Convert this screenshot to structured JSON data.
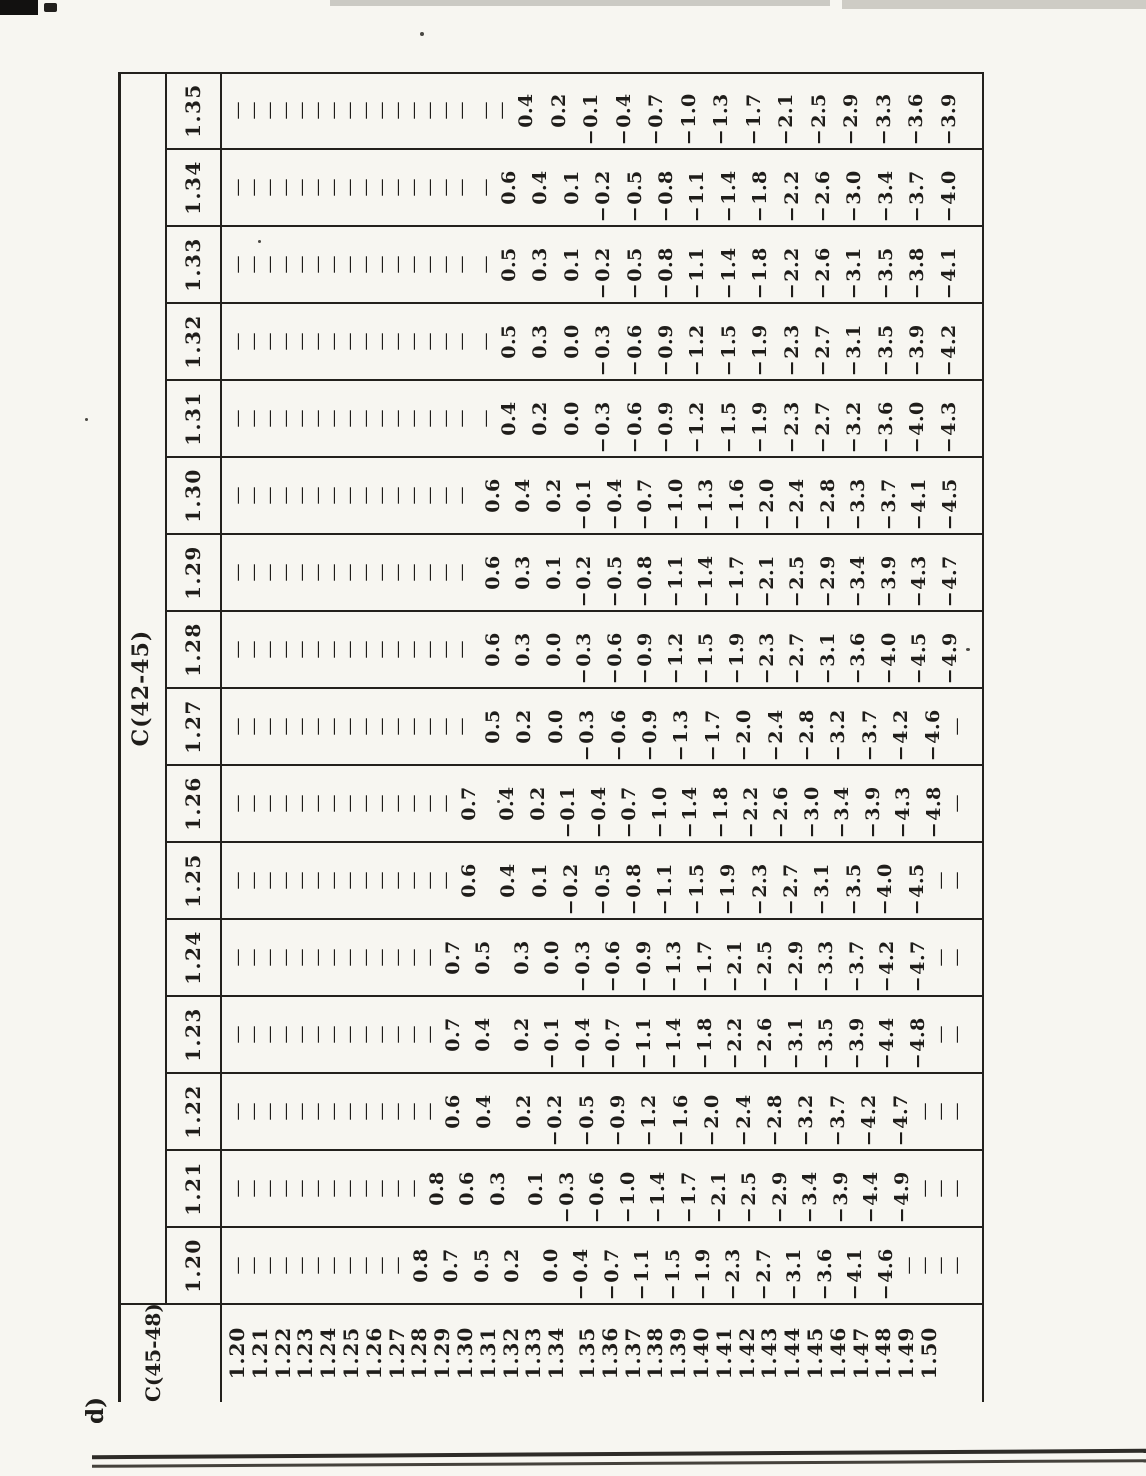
{
  "figure_label": "d)",
  "table": {
    "col_group_label": "C(42-45)",
    "row_group_label": "C(45-48)",
    "dash": "—",
    "columns": [
      "1.20",
      "1.21",
      "1.22",
      "1.23",
      "1.24",
      "1.25",
      "1.26",
      "1.27",
      "1.28",
      "1.29",
      "1.30",
      "1.31",
      "1.32",
      "1.33",
      "1.34",
      "1.35"
    ],
    "row_labels": [
      "1.20",
      "1.21",
      "1.22",
      "1.23",
      "1.24",
      "1.25",
      "1.26",
      "1.27",
      "1.28",
      "1.29",
      "1.30",
      "1.31",
      "1.32",
      "1.33",
      "1.34",
      "1.35",
      "1.36",
      "1.37",
      "1.38",
      "1.39",
      "1.40",
      "1.41",
      "1.42",
      "1.43",
      "1.44",
      "1.45",
      "1.46",
      "1.47",
      "1.48",
      "1.49",
      "1.50"
    ],
    "cells": [
      [
        "—",
        "—",
        "—",
        "—",
        "—",
        "—",
        "—",
        "—",
        "—",
        "—",
        "—",
        "—",
        "—",
        "—",
        "—",
        "—"
      ],
      [
        "—",
        "—",
        "—",
        "—",
        "—",
        "—",
        "—",
        "—",
        "—",
        "—",
        "—",
        "—",
        "—",
        "—",
        "—",
        "—"
      ],
      [
        "—",
        "—",
        "—",
        "—",
        "—",
        "—",
        "—",
        "—",
        "—",
        "—",
        "—",
        "—",
        "—",
        "—",
        "—",
        "—"
      ],
      [
        "—",
        "—",
        "—",
        "—",
        "—",
        "—",
        "—",
        "—",
        "—",
        "—",
        "—",
        "—",
        "—",
        "—",
        "—",
        "—"
      ],
      [
        "—",
        "—",
        "—",
        "—",
        "—",
        "—",
        "—",
        "—",
        "—",
        "—",
        "—",
        "—",
        "—",
        "—",
        "—",
        "—"
      ],
      [
        "—",
        "—",
        "—",
        "—",
        "—",
        "—",
        "—",
        "—",
        "—",
        "—",
        "—",
        "—",
        "—",
        "—",
        "—",
        "—"
      ],
      [
        "—",
        "—",
        "—",
        "—",
        "—",
        "—",
        "—",
        "—",
        "—",
        "—",
        "—",
        "—",
        "—",
        "—",
        "—",
        "—"
      ],
      [
        "—",
        "—",
        "—",
        "—",
        "—",
        "—",
        "—",
        "—",
        "—",
        "—",
        "—",
        "—",
        "—",
        "—",
        "—",
        "—"
      ],
      [
        "—",
        "—",
        "—",
        "—",
        "—",
        "—",
        "—",
        "—",
        "—",
        "—",
        "—",
        "—",
        "—",
        "—",
        "—",
        "—"
      ],
      [
        "—",
        "—",
        "—",
        "—",
        "—",
        "—",
        "—",
        "—",
        "—",
        "—",
        "—",
        "—",
        "—",
        "—",
        "—",
        "—"
      ],
      [
        "—",
        "—",
        "—",
        "—",
        "—",
        "—",
        "—",
        "—",
        "—",
        "—",
        "—",
        "—",
        "—",
        "—",
        "—",
        "—"
      ],
      [
        "0.8",
        "—",
        "—",
        "—",
        "—",
        "—",
        "—",
        "—",
        "—",
        "—",
        "—",
        "—",
        "—",
        "—",
        "—",
        "—"
      ],
      [
        "0.7",
        "0.8",
        "—",
        "—",
        "—",
        "—",
        "—",
        "—",
        "—",
        "—",
        "—",
        "—",
        "—",
        "—",
        "—",
        "—"
      ],
      [
        "0.5",
        "0.6",
        "0.6",
        "0.7",
        "0.7",
        "—",
        "—",
        "—",
        "—",
        "—",
        "—",
        "—",
        "—",
        "—",
        "—",
        "—"
      ],
      [
        "0.2",
        "0.3",
        "0.4",
        "0.4",
        "0.5",
        "0.6",
        "0.7",
        "—",
        "—",
        "—",
        "—",
        "—",
        "—",
        "—",
        "—",
        "—"
      ],
      [
        "0.0",
        "0.1",
        "0.2",
        "0.2",
        "0.3",
        "0.4",
        "0.4",
        "0.5",
        "0.6",
        "0.6",
        "0.6",
        "—",
        "—",
        "—",
        "—",
        "—"
      ],
      [
        "−0.4",
        "−0.3",
        "−0.2",
        "−0.1",
        "0.0",
        "0.1",
        "0.2",
        "0.2",
        "0.3",
        "0.3",
        "0.4",
        "0.4",
        "0.5",
        "0.5",
        "0.6",
        "—"
      ],
      [
        "−0.7",
        "−0.6",
        "−0.5",
        "−0.4",
        "−0.3",
        "−0.2",
        "−0.1",
        "0.0",
        "0.0",
        "0.1",
        "0.2",
        "0.2",
        "0.3",
        "0.3",
        "0.4",
        "0.4"
      ],
      [
        "−1.1",
        "−1.0",
        "−0.9",
        "−0.7",
        "−0.6",
        "−0.5",
        "−0.4",
        "−0.3",
        "−0.3",
        "−0.2",
        "−0.1",
        "0.0",
        "0.0",
        "0.1",
        "0.1",
        "0.2"
      ],
      [
        "−1.5",
        "−1.4",
        "−1.2",
        "−1.1",
        "−0.9",
        "−0.8",
        "−0.7",
        "−0.6",
        "−0.6",
        "−0.5",
        "−0.4",
        "−0.3",
        "−0.3",
        "−0.2",
        "−0.2",
        "−0.1"
      ],
      [
        "−1.9",
        "−1.7",
        "−1.6",
        "−1.4",
        "−1.3",
        "−1.1",
        "−1.0",
        "−0.9",
        "−0.9",
        "−0.8",
        "−0.7",
        "−0.6",
        "−0.6",
        "−0.5",
        "−0.5",
        "−0.4"
      ],
      [
        "−2.3",
        "−2.1",
        "−2.0",
        "−1.8",
        "−1.7",
        "−1.5",
        "−1.4",
        "−1.3",
        "−1.2",
        "−1.1",
        "−1.0",
        "−0.9",
        "−0.9",
        "−0.8",
        "−0.8",
        "−0.7"
      ],
      [
        "−2.7",
        "−2.5",
        "−2.4",
        "−2.2",
        "−2.1",
        "−1.9",
        "−1.8",
        "−1.7",
        "−1.5",
        "−1.4",
        "−1.3",
        "−1.2",
        "−1.2",
        "−1.1",
        "−1.1",
        "−1.0"
      ],
      [
        "−3.1",
        "−2.9",
        "−2.8",
        "−2.6",
        "−2.5",
        "−2.3",
        "−2.2",
        "−2.0",
        "−1.9",
        "−1.7",
        "−1.6",
        "−1.5",
        "−1.5",
        "−1.4",
        "−1.4",
        "−1.3"
      ],
      [
        "−3.6",
        "−3.4",
        "−3.2",
        "−3.1",
        "−2.9",
        "−2.7",
        "−2.6",
        "−2.4",
        "−2.3",
        "−2.1",
        "−2.0",
        "−1.9",
        "−1.9",
        "−1.8",
        "−1.8",
        "−1.7"
      ],
      [
        "−4.1",
        "−3.9",
        "−3.7",
        "−3.5",
        "−3.3",
        "−3.1",
        "−3.0",
        "−2.8",
        "−2.7",
        "−2.5",
        "−2.4",
        "−2.3",
        "−2.3",
        "−2.2",
        "−2.2",
        "−2.1"
      ],
      [
        "−4.6",
        "−4.4",
        "−4.2",
        "−3.9",
        "−3.7",
        "−3.5",
        "−3.4",
        "−3.2",
        "−3.1",
        "−2.9",
        "−2.8",
        "−2.7",
        "−2.7",
        "−2.6",
        "−2.6",
        "−2.5"
      ],
      [
        "—",
        "−4.9",
        "−4.7",
        "−4.4",
        "−4.2",
        "−4.0",
        "−3.9",
        "−3.7",
        "−3.6",
        "−3.4",
        "−3.3",
        "−3.2",
        "−3.1",
        "−3.1",
        "−3.0",
        "−2.9"
      ],
      [
        "—",
        "—",
        "—",
        "−4.8",
        "−4.7",
        "−4.5",
        "−4.3",
        "−4.2",
        "−4.0",
        "−3.9",
        "−3.7",
        "−3.6",
        "−3.5",
        "−3.5",
        "−3.4",
        "−3.3"
      ],
      [
        "—",
        "—",
        "—",
        "—",
        "—",
        "—",
        "−4.8",
        "−4.6",
        "−4.5",
        "−4.3",
        "−4.1",
        "−4.0",
        "−3.9",
        "−3.8",
        "−3.7",
        "−3.6"
      ],
      [
        "—",
        "—",
        "—",
        "—",
        "—",
        "—",
        "—",
        "—",
        "−4.9",
        "−4.7",
        "−4.5",
        "−4.3",
        "−4.2",
        "−4.1",
        "−4.0",
        "−3.9"
      ]
    ]
  }
}
